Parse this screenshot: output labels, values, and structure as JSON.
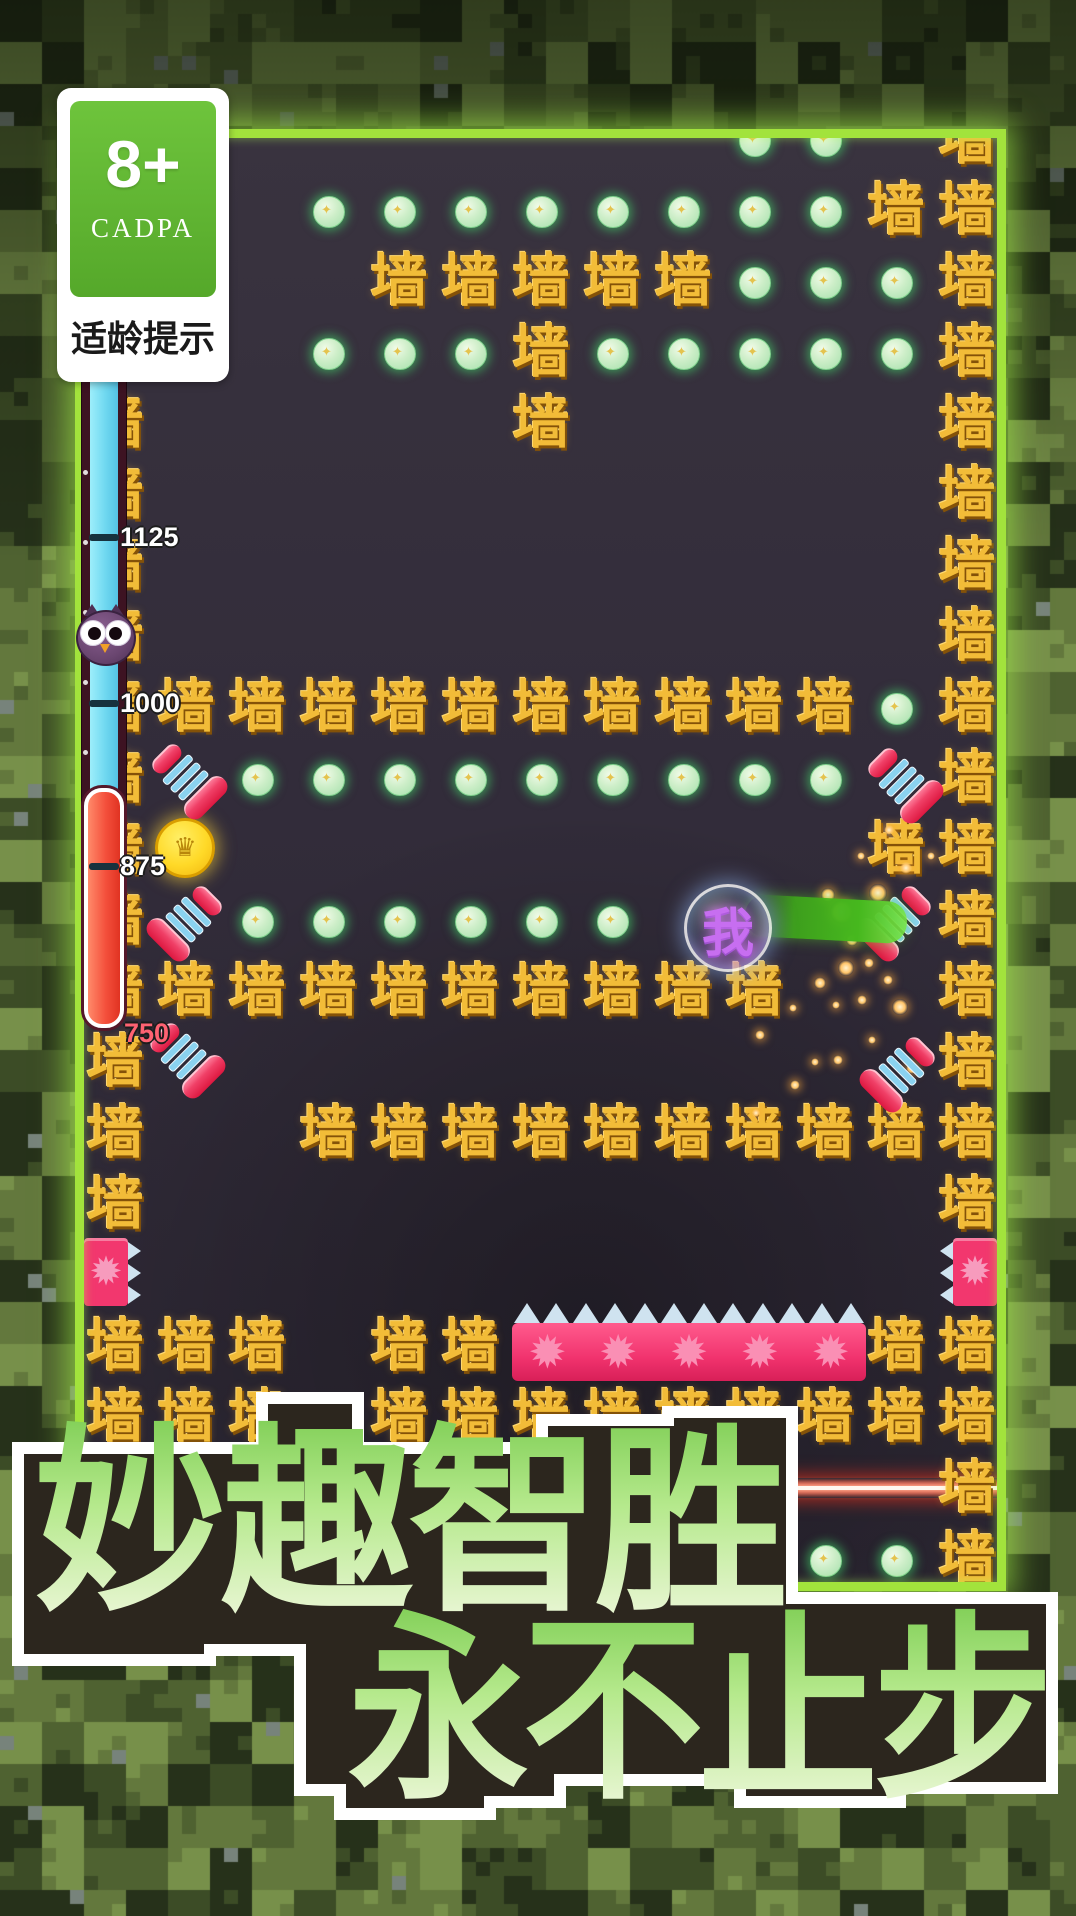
{
  "age_badge": {
    "rating": "8+",
    "org": "CADPA",
    "caption": "适龄提示"
  },
  "progress_bar": {
    "ticks": [
      {
        "label": "1125",
        "y": 537
      },
      {
        "label": "1000",
        "y": 703
      },
      {
        "label": "875",
        "y": 866
      }
    ],
    "end_label": {
      "text": "750",
      "y": 1018,
      "color": "#ff6272"
    },
    "owl": "owl-marker",
    "colors": {
      "top": "#6fd8f0",
      "bottom": "#f4503c"
    }
  },
  "board": {
    "wall_char": "墙",
    "gem_star": "✦",
    "burst_char": "✹",
    "grid_cell": 71,
    "walls": [
      [
        12,
        0
      ],
      [
        11,
        1
      ],
      [
        12,
        1
      ],
      [
        4,
        2
      ],
      [
        5,
        2
      ],
      [
        6,
        2
      ],
      [
        7,
        2
      ],
      [
        8,
        2
      ],
      [
        12,
        2
      ],
      [
        6,
        3
      ],
      [
        12,
        3
      ],
      [
        0,
        4
      ],
      [
        6,
        4
      ],
      [
        12,
        4
      ],
      [
        0,
        5
      ],
      [
        12,
        5
      ],
      [
        0,
        6
      ],
      [
        12,
        6
      ],
      [
        0,
        7
      ],
      [
        12,
        7
      ],
      [
        0,
        8
      ],
      [
        1,
        8
      ],
      [
        2,
        8
      ],
      [
        3,
        8
      ],
      [
        4,
        8
      ],
      [
        5,
        8
      ],
      [
        6,
        8
      ],
      [
        7,
        8
      ],
      [
        8,
        8
      ],
      [
        9,
        8
      ],
      [
        10,
        8
      ],
      [
        12,
        8
      ],
      [
        0,
        9
      ],
      [
        12,
        9
      ],
      [
        0,
        10
      ],
      [
        11,
        10
      ],
      [
        12,
        10
      ],
      [
        0,
        11
      ],
      [
        12,
        11
      ],
      [
        0,
        12
      ],
      [
        1,
        12
      ],
      [
        2,
        12
      ],
      [
        3,
        12
      ],
      [
        4,
        12
      ],
      [
        5,
        12
      ],
      [
        6,
        12
      ],
      [
        7,
        12
      ],
      [
        8,
        12
      ],
      [
        9,
        12
      ],
      [
        12,
        12
      ],
      [
        0,
        13
      ],
      [
        12,
        13
      ],
      [
        0,
        14
      ],
      [
        3,
        14
      ],
      [
        4,
        14
      ],
      [
        5,
        14
      ],
      [
        6,
        14
      ],
      [
        7,
        14
      ],
      [
        8,
        14
      ],
      [
        9,
        14
      ],
      [
        10,
        14
      ],
      [
        11,
        14
      ],
      [
        12,
        14
      ],
      [
        0,
        15
      ],
      [
        12,
        15
      ],
      [
        0,
        17
      ],
      [
        1,
        17
      ],
      [
        2,
        17
      ],
      [
        4,
        17
      ],
      [
        5,
        17
      ],
      [
        11,
        17
      ],
      [
        12,
        17
      ],
      [
        0,
        18
      ],
      [
        1,
        18
      ],
      [
        2,
        18
      ],
      [
        4,
        18
      ],
      [
        5,
        18
      ],
      [
        6,
        18
      ],
      [
        7,
        18
      ],
      [
        8,
        18
      ],
      [
        9,
        18
      ],
      [
        10,
        18
      ],
      [
        11,
        18
      ],
      [
        12,
        18
      ],
      [
        12,
        19
      ],
      [
        12,
        20
      ]
    ],
    "gems": [
      [
        9,
        0
      ],
      [
        10,
        0
      ],
      [
        3,
        1
      ],
      [
        4,
        1
      ],
      [
        5,
        1
      ],
      [
        6,
        1
      ],
      [
        7,
        1
      ],
      [
        8,
        1
      ],
      [
        9,
        1
      ],
      [
        10,
        1
      ],
      [
        9,
        2
      ],
      [
        10,
        2
      ],
      [
        11,
        2
      ],
      [
        3,
        3
      ],
      [
        4,
        3
      ],
      [
        5,
        3
      ],
      [
        7,
        3
      ],
      [
        8,
        3
      ],
      [
        9,
        3
      ],
      [
        10,
        3
      ],
      [
        11,
        3
      ],
      [
        11,
        8
      ],
      [
        2,
        9
      ],
      [
        3,
        9
      ],
      [
        4,
        9
      ],
      [
        5,
        9
      ],
      [
        6,
        9
      ],
      [
        7,
        9
      ],
      [
        8,
        9
      ],
      [
        9,
        9
      ],
      [
        10,
        9
      ],
      [
        2,
        11
      ],
      [
        3,
        11
      ],
      [
        4,
        11
      ],
      [
        5,
        11
      ],
      [
        6,
        11
      ],
      [
        7,
        11
      ],
      [
        9,
        20
      ],
      [
        10,
        20
      ],
      [
        11,
        20
      ]
    ],
    "coin": {
      "x": 182,
      "y": 845,
      "symbol": "♛"
    },
    "springs": [
      {
        "x": 187,
        "y": 779,
        "rot": "A"
      },
      {
        "x": 903,
        "y": 783,
        "rot": "A"
      },
      {
        "x": 187,
        "y": 921,
        "rot": "B"
      },
      {
        "x": 896,
        "y": 921,
        "rot": "B"
      },
      {
        "x": 185,
        "y": 1058,
        "rot": "A"
      },
      {
        "x": 900,
        "y": 1072,
        "rot": "B"
      }
    ],
    "player": {
      "char": "我",
      "x": 725,
      "y": 925
    },
    "beam": {
      "x": 745,
      "y": 898,
      "w": 162,
      "h": 42
    },
    "sparks": [
      [
        878,
        893,
        9
      ],
      [
        906,
        868,
        6
      ],
      [
        852,
        940,
        6
      ],
      [
        820,
        983,
        6
      ],
      [
        862,
        1000,
        5
      ],
      [
        900,
        1007,
        8
      ],
      [
        760,
        1035,
        5
      ],
      [
        793,
        1008,
        4
      ],
      [
        838,
        1060,
        5
      ],
      [
        872,
        1040,
        4
      ],
      [
        912,
        1068,
        6
      ],
      [
        795,
        1085,
        5
      ],
      [
        756,
        1113,
        4
      ],
      [
        836,
        1005,
        4
      ],
      [
        869,
        963,
        5
      ],
      [
        889,
        830,
        5
      ],
      [
        931,
        856,
        4
      ],
      [
        861,
        856,
        4
      ],
      [
        842,
        912,
        12
      ],
      [
        828,
        895,
        7
      ],
      [
        884,
        922,
        6
      ],
      [
        846,
        968,
        8
      ],
      [
        815,
        1062,
        4
      ],
      [
        888,
        980,
        5
      ]
    ],
    "spike_blocks": [
      {
        "x": 84,
        "y": 1238,
        "w": 44,
        "h": 68,
        "dir": "right"
      },
      {
        "x": 953,
        "y": 1238,
        "w": 44,
        "h": 68,
        "dir": "left"
      }
    ],
    "spike_bar": {
      "x": 512,
      "y": 1303,
      "w": 354,
      "bursts": 5,
      "teeth": 12
    },
    "laser": {
      "x": 714,
      "y": 1488,
      "w": 284
    }
  },
  "slogan": {
    "line1": "妙趣智胜",
    "line2": "永不止步"
  }
}
